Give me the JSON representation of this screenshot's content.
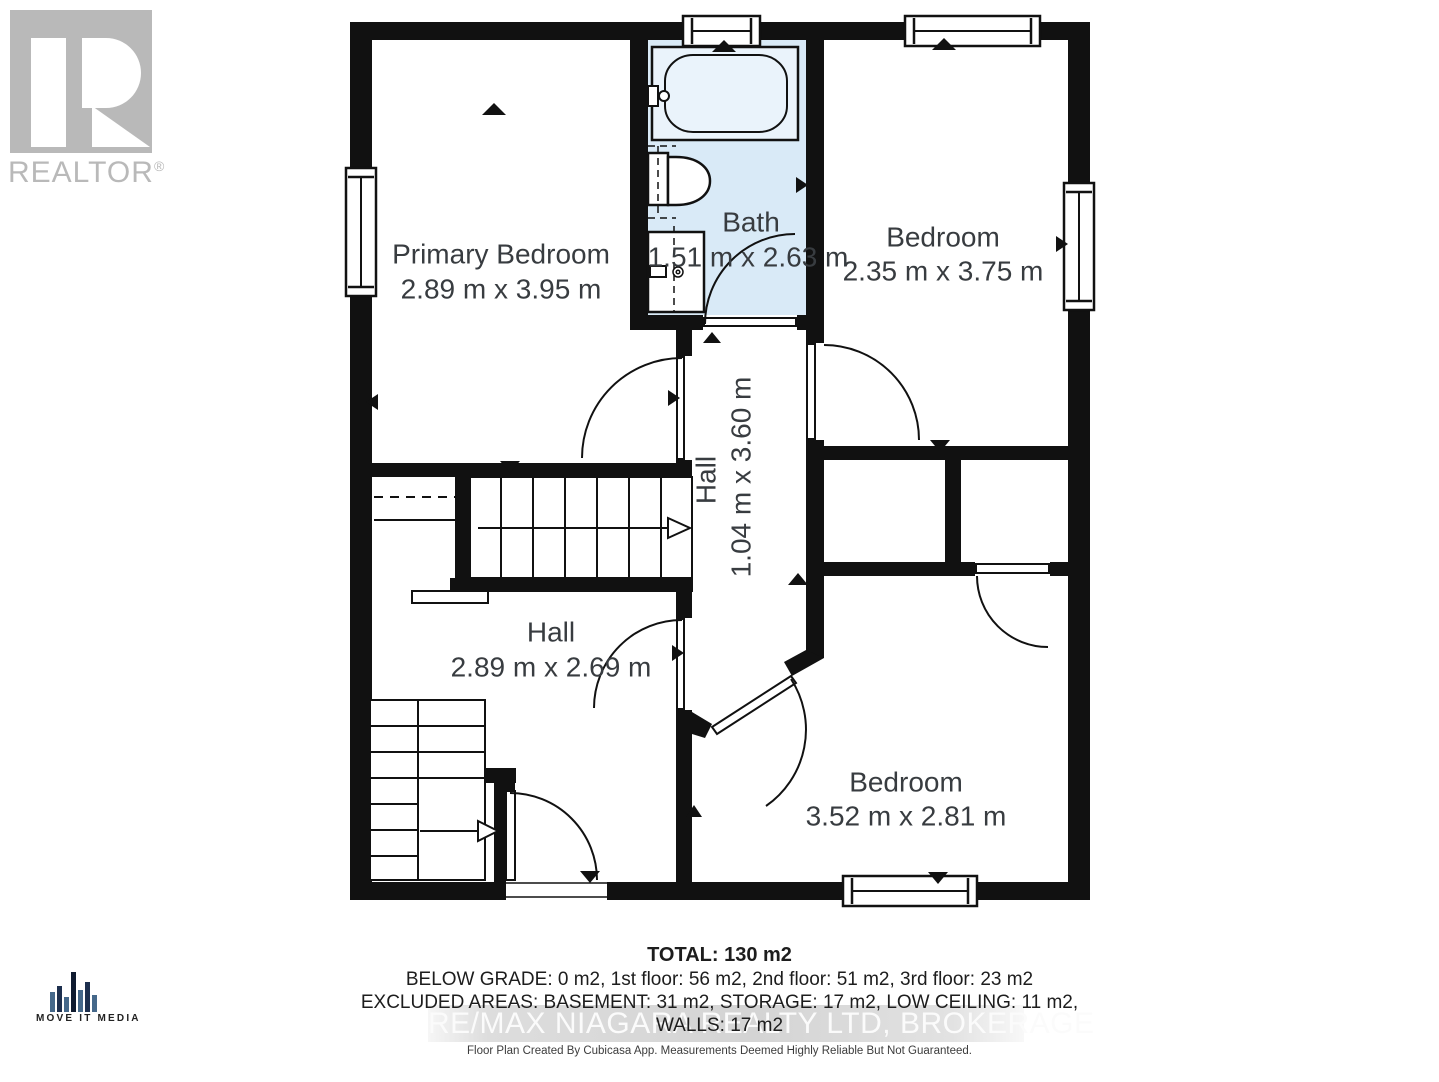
{
  "branding": {
    "realtor_logo_text": "REALTOR",
    "realtor_reg_mark": "®",
    "media_logo_text": "MOVE IT MEDIA"
  },
  "floor_plan": {
    "rooms": [
      {
        "name": "Primary Bedroom",
        "dims": "2.89 m x 3.95 m"
      },
      {
        "name": "Bath",
        "dims": "1.51 m x 2.63 m"
      },
      {
        "name": "Bedroom",
        "dims": "2.35 m x 3.75 m"
      },
      {
        "name": "Hall",
        "dims": "1.04 m x 3.60 m"
      },
      {
        "name": "Hall",
        "dims": "2.89 m x 2.69 m"
      },
      {
        "name": "Bedroom",
        "dims": "3.52 m x 2.81 m"
      }
    ]
  },
  "summary": {
    "total": "TOTAL: 130 m2",
    "floors": "BELOW GRADE: 0 m2, 1st floor: 56 m2, 2nd floor: 51 m2, 3rd floor: 23 m2",
    "excluded": "EXCLUDED AREAS: BASEMENT: 31 m2, STORAGE: 17 m2, LOW CEILING: 11 m2,",
    "walls": "WALLS: 17 m2"
  },
  "watermark": "RE/MAX NIAGARA REALTY LTD, BROKERAGE",
  "disclaimer": "Floor Plan Created By Cubicasa App. Measurements Deemed Highly Reliable But Not Guaranteed.",
  "colors": {
    "wall": "#111111",
    "bath_floor": "#d9eaf7",
    "label_text": "#383c40",
    "watermark_text": "#fbfbfb",
    "watermark_band": "#d4d4d4",
    "realtor_gray": "#b9b9b9",
    "media_navy": "#1d2f4e",
    "media_steel": "#45688a"
  }
}
